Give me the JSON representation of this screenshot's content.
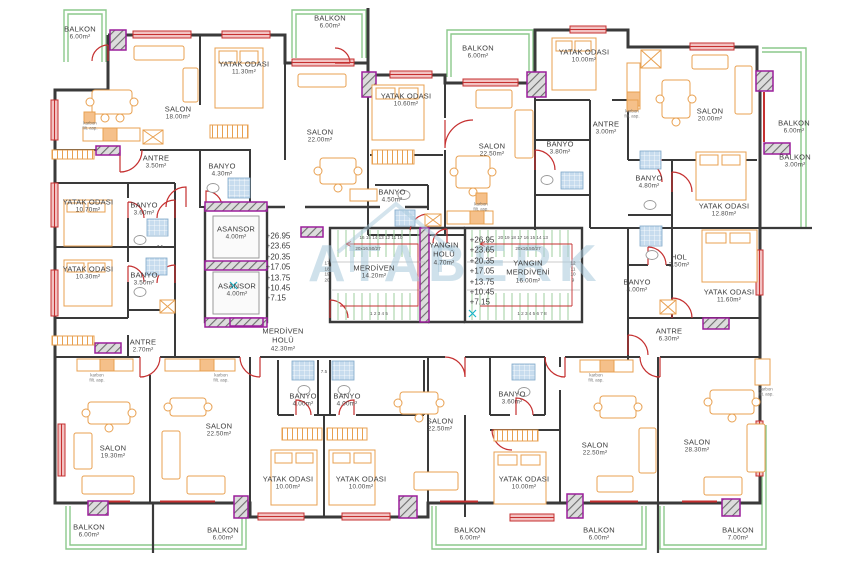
{
  "drawing_type": "apartment floor plan",
  "watermark": {
    "text": "ATABERK",
    "color": "#a9cadc"
  },
  "colors": {
    "wall": "#3a3a3a",
    "window": "#c53030",
    "door": "#c53030",
    "balcony_rail": "#8cc98c",
    "column_border": "#9b1f9b",
    "furniture": "#e8a050",
    "tile": "#c7dcee",
    "text": "#3c3c3c"
  },
  "rooms": [
    {
      "label": "BALKON",
      "area": "6.00m²"
    },
    {
      "label": "SALON",
      "area": "18.00m²"
    },
    {
      "label": "YATAK ODASI",
      "area": "11.30m²"
    },
    {
      "label": "ANTRE",
      "area": "3.50m²"
    },
    {
      "label": "BANYO",
      "area": "4.30m²"
    },
    {
      "label": "BALKON",
      "area": "6.00m²"
    },
    {
      "label": "SALON",
      "area": "22.00m²"
    },
    {
      "label": "YATAK ODASI",
      "area": "10.60m²"
    },
    {
      "label": "BANYO",
      "area": "4.50m²"
    },
    {
      "label": "BALKON",
      "area": "6.00m²"
    },
    {
      "label": "SALON",
      "area": "22.50m²"
    },
    {
      "label": "BANYO",
      "area": "3.80m²"
    },
    {
      "label": "ANTRE",
      "area": "3.00m²"
    },
    {
      "label": "YATAK ODASI",
      "area": "10.00m²"
    },
    {
      "label": "SALON",
      "area": "20.00m²"
    },
    {
      "label": "BALKON",
      "area": "6.00m²"
    },
    {
      "label": "BALKON",
      "area": "3.00m²"
    },
    {
      "label": "BANYO",
      "area": "4.80m²"
    },
    {
      "label": "YATAK ODASI",
      "area": "12.80m²"
    },
    {
      "label": "YATAK ODASI",
      "area": "10.70m²"
    },
    {
      "label": "BANYO",
      "area": "3.60m²"
    },
    {
      "label": "YATAK ODASI",
      "area": "10.30m²"
    },
    {
      "label": "BANYO",
      "area": "3.50m²"
    },
    {
      "label": "ANTRE",
      "area": "2.70m²"
    },
    {
      "label": "ASANSOR",
      "area": "4.00m²"
    },
    {
      "label": "ASANSOR",
      "area": "4.00m²"
    },
    {
      "label": "MERDİVEN HOLÜ",
      "area": "42.30m²"
    },
    {
      "label": "MERDİVEN",
      "area": "14.20m²"
    },
    {
      "label": "YANGIN HOLÜ",
      "area": "4.70m²"
    },
    {
      "label": "YANGIN MERDİVENİ",
      "area": "16.00m²"
    },
    {
      "label": "HOL",
      "area": "3.50m²"
    },
    {
      "label": "BANYO",
      "area": "4.00m²"
    },
    {
      "label": "YATAK ODASI",
      "area": "11.60m²"
    },
    {
      "label": "ANTRE",
      "area": "6.30m²"
    },
    {
      "label": "SALON",
      "area": "19.30m²"
    },
    {
      "label": "SALON",
      "area": "22.50m²"
    },
    {
      "label": "BANYO",
      "area": "4.00m²"
    },
    {
      "label": "BANYO",
      "area": "4.00m²"
    },
    {
      "label": "YATAK ODASI",
      "area": "10.00m²"
    },
    {
      "label": "YATAK ODASI",
      "area": "10.00m²"
    },
    {
      "label": "SALON",
      "area": "22.50m²"
    },
    {
      "label": "BANYO",
      "area": "3.60m²"
    },
    {
      "label": "YATAK ODASI",
      "area": "10.00m²"
    },
    {
      "label": "SALON",
      "area": "22.50m²"
    },
    {
      "label": "SALON",
      "area": "28.30m²"
    },
    {
      "label": "BALKON",
      "area": "6.00m²"
    },
    {
      "label": "BALKON",
      "area": "6.00m²"
    },
    {
      "label": "BALKON",
      "area": "6.00m²"
    },
    {
      "label": "BALKON",
      "area": "6.00m²"
    },
    {
      "label": "BALKON",
      "area": "7.00m²"
    }
  ],
  "annotations": {
    "elevations": "+26.95\n+23.65\n+20.35\n+17.05\n+13.75\n+10.45\n+7.15",
    "left_stair": {
      "top_numbers": "16 15 14 13 12 11 10",
      "dimension": "20x16.50/27",
      "side_numbers": "17\n18\n19\n20",
      "bottom_numbers": "1 2 3 4 5"
    },
    "right_stair": {
      "top_numbers": "20 19 18 17 16 15 14 13",
      "dimension": "20x16.50/27",
      "side_numbers": "12\n11\n10\n9",
      "bottom_numbers": "1 2 3 4 5 6 7 8"
    },
    "vent_label": "karbon\nfilt. asp.",
    "shaft_label": "7.5"
  }
}
